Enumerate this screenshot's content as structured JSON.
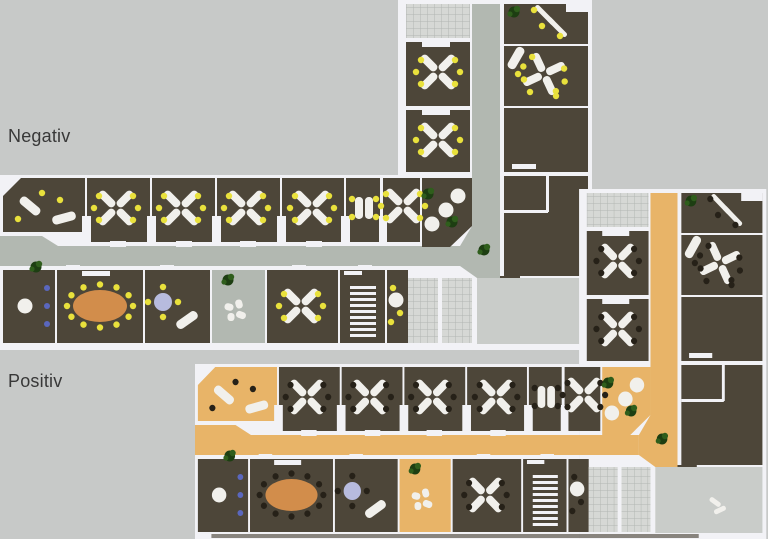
{
  "canvas": {
    "width": 768,
    "height": 539
  },
  "labels": {
    "negativ": "Negativ",
    "positiv": "Positiv"
  },
  "colors": {
    "background": "#c7c9c8",
    "wall": "#f2f2f6",
    "room_dark": "#4d4639",
    "plaza": "#c9ccc9",
    "grid_bg": "#d6d8d5",
    "grid_line": "#b2b6b2",
    "desk": "#f1f0ec",
    "table_conference": "#d28d4b",
    "table_lavender": "#b7bbde",
    "plant_dark": "#1d3e12",
    "plant_light": "#2f5e1c",
    "chair_blue": "#5a67be",
    "shadow": "#4e483e",
    "label_text": "#383838"
  },
  "plans": [
    {
      "id": "negativ",
      "label_key": "negativ",
      "origin": [
        0,
        0
      ],
      "scale_x": 1,
      "corridor": "#b2b8b1",
      "chair": "#e9e13c",
      "open": false,
      "shadow": false,
      "figure": null
    },
    {
      "id": "positiv",
      "label_key": "positiv",
      "origin": [
        195,
        189
      ],
      "scale_x": 0.965,
      "corridor": "#e8b468",
      "chair": "#262118",
      "open": true,
      "shadow": true,
      "figure": [
        542,
        317
      ]
    }
  ],
  "geometry": {
    "slabs": [
      [
        398,
        0,
        194,
        350
      ],
      [
        0,
        175,
        398,
        175
      ]
    ],
    "corridors": [
      {
        "poly": [
          [
            0,
            236
          ],
          [
            42,
            236
          ],
          [
            58,
            246
          ],
          [
            460,
            246
          ],
          [
            460,
            266
          ],
          [
            0,
            266
          ]
        ]
      },
      {
        "r": [
          472,
          4,
          28,
          224
        ]
      },
      {
        "poly": [
          [
            460,
            246
          ],
          [
            472,
            226
          ],
          [
            500,
            226
          ],
          [
            500,
            278
          ],
          [
            477,
            278
          ],
          [
            460,
            266
          ]
        ]
      }
    ],
    "rooms": [
      {
        "r": [
          406,
          4,
          64,
          34
        ],
        "f": "grid"
      },
      {
        "r": [
          406,
          42,
          64,
          64
        ],
        "f": "dark"
      },
      {
        "r": [
          406,
          110,
          64,
          62
        ],
        "f": "dark"
      },
      {
        "r": [
          504,
          4,
          84,
          40
        ],
        "f": "dark"
      },
      {
        "r": [
          504,
          46,
          84,
          60
        ],
        "f": "dark"
      },
      {
        "r": [
          504,
          108,
          84,
          64
        ],
        "f": "dark"
      },
      {
        "r": [
          504,
          176,
          84,
          100
        ],
        "f": "dark"
      },
      {
        "r": [
          500,
          276,
          20,
          14
        ],
        "f": "dark"
      },
      {
        "poly": [
          [
            3,
            196
          ],
          [
            21,
            178
          ],
          [
            85,
            178
          ],
          [
            85,
            232
          ],
          [
            3,
            232
          ]
        ],
        "f": "dark",
        "pv": true
      },
      {
        "r": [
          87,
          178,
          63,
          64
        ],
        "f": "dark"
      },
      {
        "r": [
          152,
          178,
          63,
          64
        ],
        "f": "dark"
      },
      {
        "r": [
          217,
          178,
          63,
          64
        ],
        "f": "dark"
      },
      {
        "r": [
          282,
          178,
          62,
          64
        ],
        "f": "dark"
      },
      {
        "r": [
          346,
          178,
          34,
          64
        ],
        "f": "dark"
      },
      {
        "r": [
          383,
          178,
          37,
          64
        ],
        "f": "dark"
      },
      {
        "poly": [
          [
            422,
            178
          ],
          [
            472,
            178
          ],
          [
            472,
            226
          ],
          [
            450,
            247
          ],
          [
            422,
            247
          ]
        ],
        "f": "dark",
        "pv": true
      },
      {
        "r": [
          3,
          270,
          52,
          73
        ],
        "f": "dark"
      },
      {
        "r": [
          57,
          270,
          86,
          73
        ],
        "f": "dark"
      },
      {
        "r": [
          145,
          270,
          65,
          73
        ],
        "f": "dark"
      },
      {
        "r": [
          212,
          270,
          53,
          73
        ],
        "f": "corridor"
      },
      {
        "r": [
          267,
          270,
          71,
          73
        ],
        "f": "dark"
      },
      {
        "r": [
          340,
          270,
          45,
          73
        ],
        "f": "dark"
      },
      {
        "r": [
          387,
          270,
          21,
          73
        ],
        "f": "dark"
      },
      {
        "r": [
          408,
          278,
          30,
          65
        ],
        "f": "grid"
      },
      {
        "r": [
          442,
          278,
          30,
          65
        ],
        "f": "grid"
      },
      {
        "r": [
          477,
          278,
          111,
          66
        ],
        "f": "plaza"
      }
    ],
    "partitions": [
      [
        422,
        42,
        28,
        5
      ],
      [
        422,
        110,
        28,
        5
      ],
      [
        504,
        210,
        44,
        3
      ],
      [
        546,
        176,
        3,
        36
      ],
      [
        82,
        216,
        9,
        26
      ],
      [
        147,
        216,
        9,
        26
      ],
      [
        212,
        216,
        9,
        26
      ],
      [
        277,
        216,
        9,
        26
      ],
      [
        341,
        216,
        9,
        26
      ],
      [
        379,
        216,
        8,
        26
      ],
      [
        110,
        241,
        16,
        6
      ],
      [
        176,
        241,
        16,
        6
      ],
      [
        240,
        241,
        16,
        6
      ],
      [
        306,
        241,
        16,
        6
      ],
      [
        66,
        265,
        14,
        5
      ],
      [
        160,
        265,
        14,
        5
      ],
      [
        292,
        265,
        14,
        5
      ],
      [
        358,
        265,
        14,
        5
      ],
      [
        344,
        271,
        18,
        4
      ],
      [
        566,
        2,
        22,
        10
      ]
    ],
    "furniture": [
      [
        "x4",
        438,
        72
      ],
      [
        "x4",
        438,
        140
      ],
      [
        "diag2",
        550,
        20
      ],
      [
        "plant",
        514,
        12
      ],
      [
        "chair",
        534,
        10
      ],
      [
        "chair",
        542,
        26
      ],
      [
        "chair",
        560,
        36
      ],
      [
        "x4",
        544,
        74,
        20
      ],
      [
        "curve",
        516,
        58,
        -60
      ],
      [
        "chair",
        518,
        74
      ],
      [
        "chair",
        530,
        92
      ],
      [
        "chair",
        556,
        96
      ],
      [
        "sideboard",
        512,
        164,
        24,
        5
      ],
      [
        "curve",
        30,
        206,
        40
      ],
      [
        "curve",
        64,
        218,
        -15
      ],
      [
        "chair",
        42,
        193
      ],
      [
        "chair",
        18,
        219
      ],
      [
        "chair",
        60,
        200
      ],
      [
        "x4",
        116,
        208
      ],
      [
        "x4",
        181,
        208
      ],
      [
        "x4",
        246,
        208
      ],
      [
        "x4",
        312,
        208
      ],
      [
        "x2",
        364,
        208
      ],
      [
        "x4",
        403,
        206
      ],
      [
        "round",
        432,
        224
      ],
      [
        "round",
        446,
        210
      ],
      [
        "round",
        458,
        196
      ],
      [
        "plant",
        428,
        194
      ],
      [
        "plant",
        452,
        222
      ],
      [
        "plant",
        484,
        250
      ],
      [
        "round",
        25,
        306
      ],
      [
        "bluechairs",
        47,
        288
      ],
      [
        "oval",
        100,
        306
      ],
      [
        "sideboard",
        82,
        271,
        28,
        5
      ],
      [
        "lav",
        163,
        302
      ],
      [
        "curve",
        187,
        320,
        -35
      ],
      [
        "plant",
        228,
        280
      ],
      [
        "lounge",
        238,
        314
      ],
      [
        "x4",
        301,
        306
      ],
      [
        "stairs",
        350,
        286,
        26,
        52
      ],
      [
        "round",
        396,
        300
      ],
      [
        "chair",
        393,
        288
      ],
      [
        "chair",
        400,
        313
      ],
      [
        "chair",
        391,
        322
      ],
      [
        "plant",
        36,
        267
      ]
    ]
  }
}
